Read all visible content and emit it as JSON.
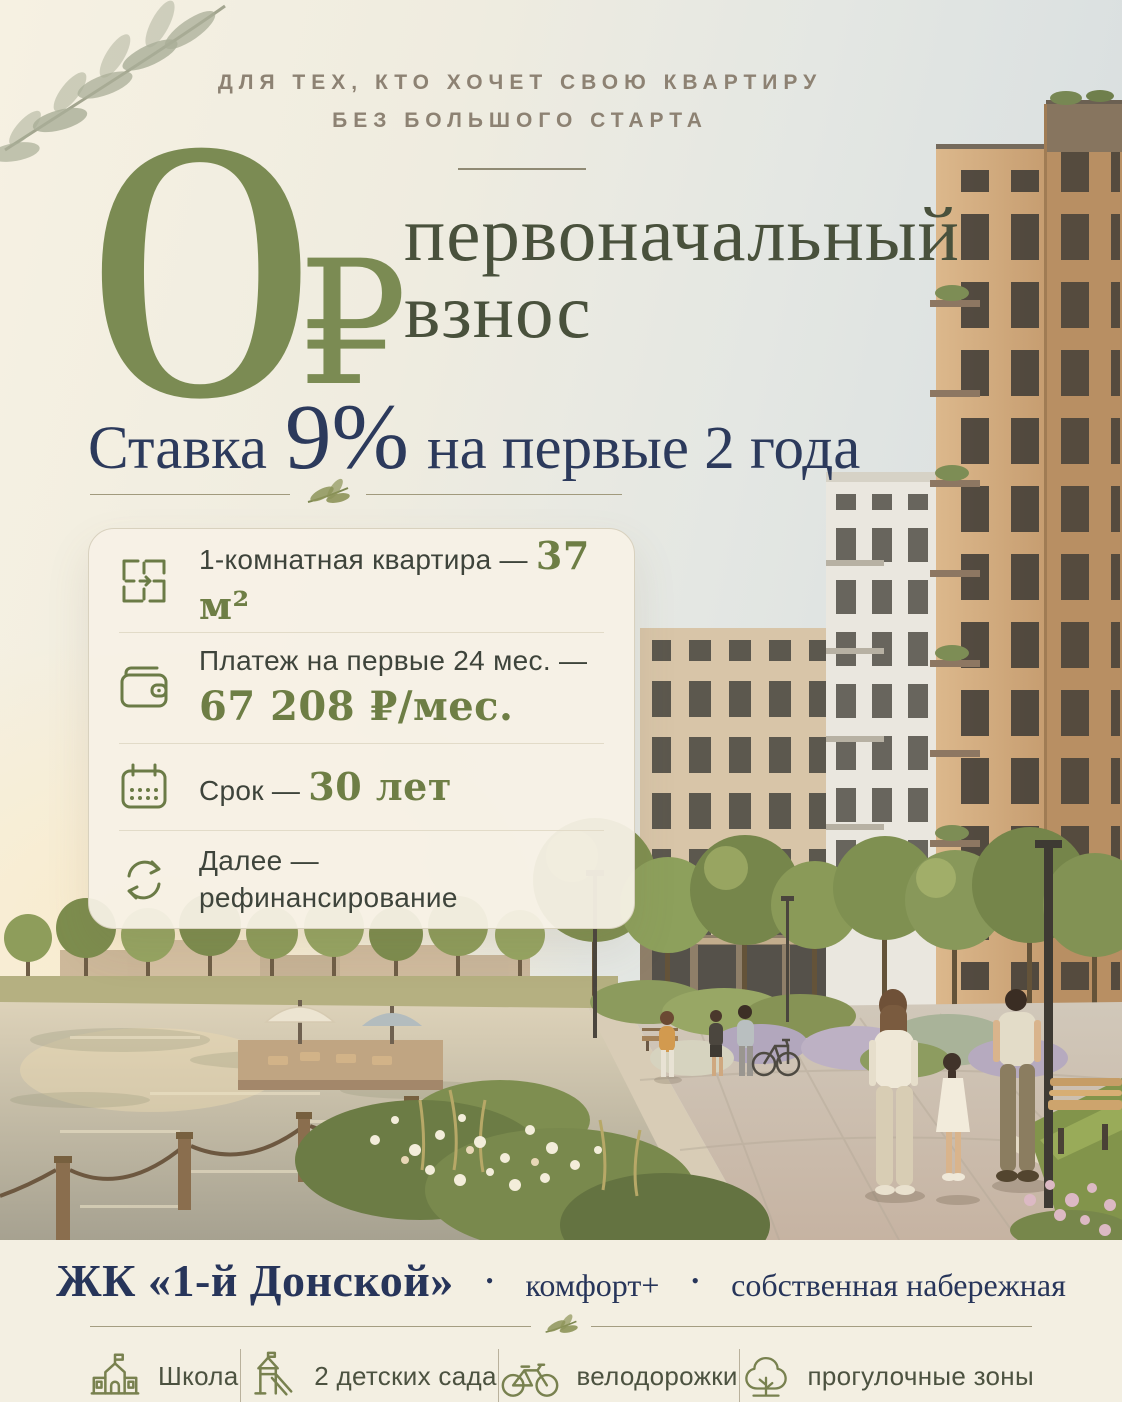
{
  "tagline": {
    "line1": "ДЛЯ ТЕХ, КТО ХОЧЕТ СВОЮ КВАРТИРУ",
    "line2": "БЕЗ БОЛЬШОГО СТАРТА"
  },
  "hero": {
    "zero": "0",
    "currency": "₽",
    "title_line1": "первоначальный",
    "title_line2": "взнос",
    "rate_prefix": "Ставка",
    "rate_value": "9%",
    "rate_suffix": "на первые 2 года"
  },
  "card": {
    "rows": [
      {
        "icon": "floorplan-icon",
        "label": "1-комнатная квартира — ",
        "value": "37 м²"
      },
      {
        "icon": "wallet-icon",
        "label": "Платеж на первые 24 мес. —",
        "value": "67 208 ₽/мес."
      },
      {
        "icon": "calendar-icon",
        "label": "Срок — ",
        "value": "30 лет"
      },
      {
        "icon": "refresh-icon",
        "label": "Далее —",
        "label2": "рефинансирование"
      }
    ]
  },
  "footer": {
    "project": "ЖК «1-й Донской»",
    "separator": "•",
    "tags": [
      "комфорт+",
      "собственная набережная"
    ],
    "amenities": [
      {
        "icon": "school-icon",
        "label": "Школа"
      },
      {
        "icon": "playground-icon",
        "label": "2 детских сада"
      },
      {
        "icon": "bicycle-icon",
        "label": "велодорожки"
      },
      {
        "icon": "tree-icon",
        "label": "прогулочные зоны"
      }
    ]
  },
  "colors": {
    "background_cream": "#f4efe1",
    "accent_olive": "#7b8b53",
    "headline_olive": "#49513c",
    "accent_navy": "#2c3a5c",
    "value_olive": "#6e7e45",
    "tagline_taupe": "#8d8273",
    "icon_olive": "#6b7b46"
  }
}
